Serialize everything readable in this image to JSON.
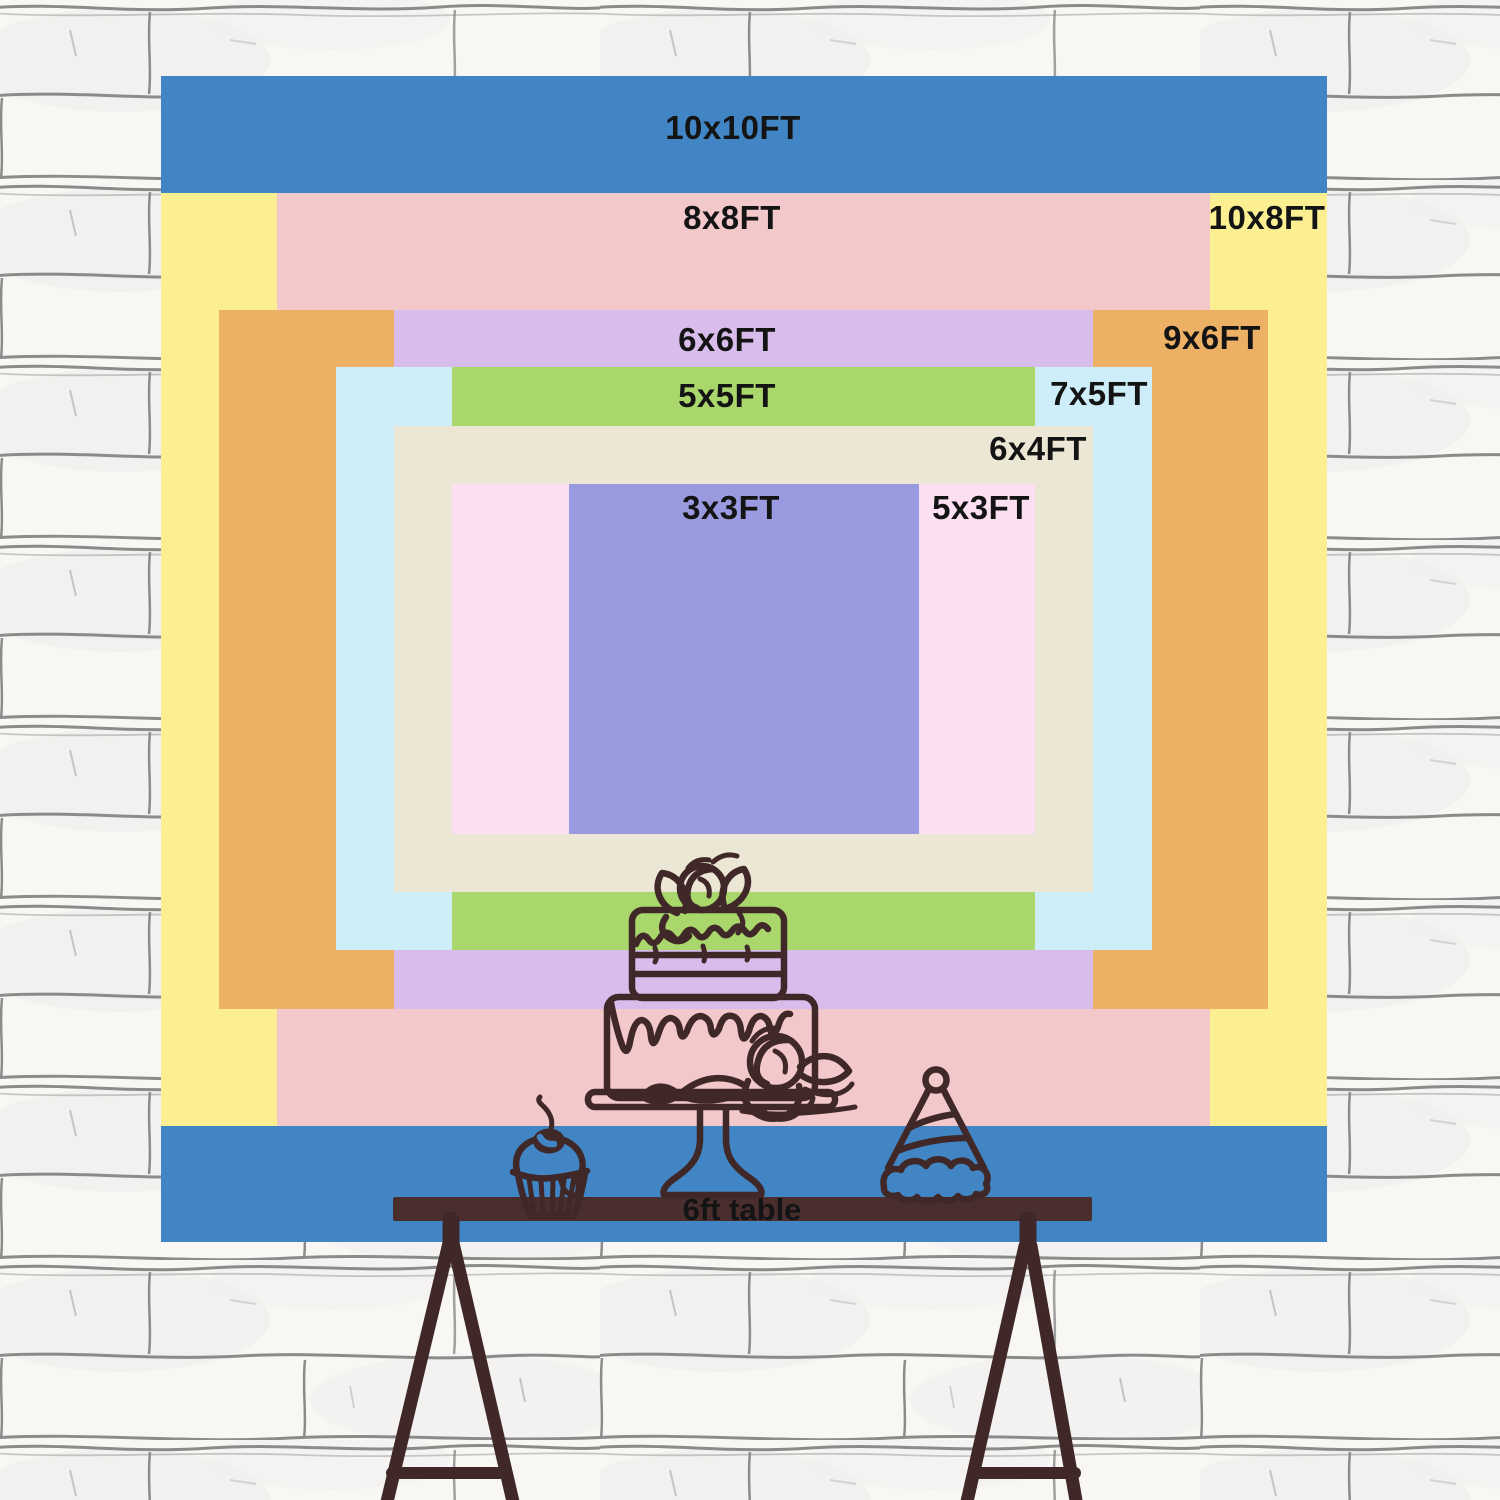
{
  "backdrop": {
    "label_color": "#141414",
    "sizes": [
      {
        "label": "10x10FT",
        "width_ft": 10,
        "height_ft": 10,
        "color": "#4285c4"
      },
      {
        "label": "10x8FT",
        "width_ft": 10,
        "height_ft": 8,
        "color": "#fbef92"
      },
      {
        "label": "8x8FT",
        "width_ft": 8,
        "height_ft": 8,
        "color": "#f3c8ca"
      },
      {
        "label": "9x6FT",
        "width_ft": 9,
        "height_ft": 6,
        "color": "#ecb165"
      },
      {
        "label": "6x6FT",
        "width_ft": 6,
        "height_ft": 6,
        "color": "#d8bdec"
      },
      {
        "label": "7x5FT",
        "width_ft": 7,
        "height_ft": 5,
        "color": "#cdeef8"
      },
      {
        "label": "5x5FT",
        "width_ft": 5,
        "height_ft": 5,
        "color": "#a9d76c"
      },
      {
        "label": "6x4FT",
        "width_ft": 6,
        "height_ft": 4,
        "color": "#ece6d4"
      },
      {
        "label": "5x3FT",
        "width_ft": 5,
        "height_ft": 3,
        "color": "#fcdff0"
      },
      {
        "label": "3x3FT",
        "width_ft": 3,
        "height_ft": 3,
        "color": "#9a9ae0"
      }
    ]
  },
  "table": {
    "label": "6ft table",
    "color": "#4a2e2d",
    "label_color": "#141414"
  },
  "illustration": {
    "outline_color": "#402828",
    "items": [
      "two-tier cake on stand",
      "cupcake with cherry",
      "party hat"
    ]
  },
  "wall": {
    "base_color": "#f8f7f4",
    "mortar_color": "#8b8b8b"
  }
}
